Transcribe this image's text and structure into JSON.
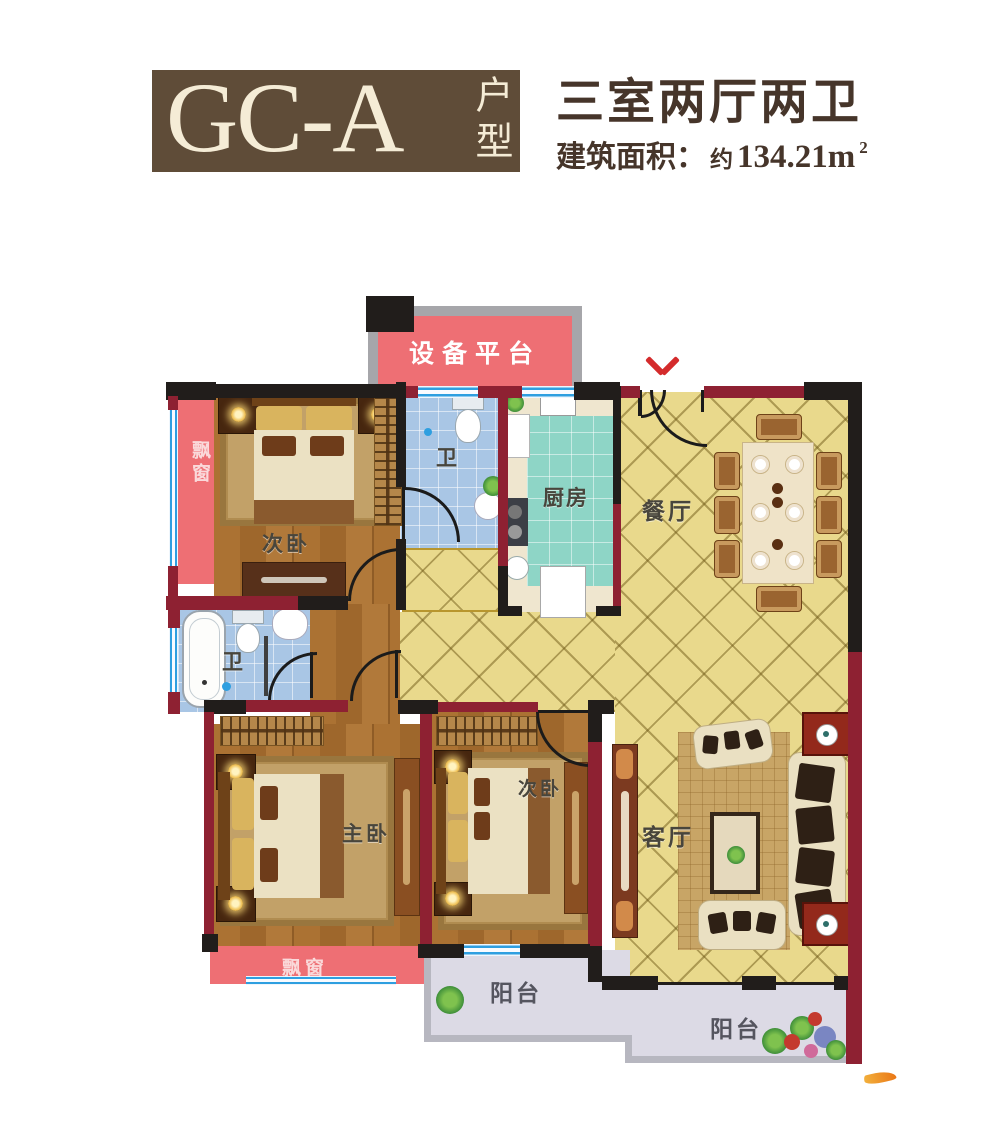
{
  "header": {
    "plan_code": "GC-A",
    "plan_type": "户型",
    "title": "三室两厅两卫",
    "area_label": "建筑面积：",
    "area_approx": "约",
    "area_value": "134.21m",
    "area_exponent": "2"
  },
  "rooms": {
    "equipment_platform": "设备平台",
    "bedroom_top": "次卧",
    "bathroom_top": "卫",
    "kitchen": "厨房",
    "dining_room": "餐厅",
    "bathroom_middle": "卫",
    "master_bedroom": "主卧",
    "bedroom_bottom": "次卧",
    "living_room": "客厅",
    "balcony_small": "阳台",
    "balcony_large": "阳台",
    "bay_window_left": "飘窗",
    "bay_window_bottom": "飘窗"
  },
  "colors": {
    "brand_brown": "#5f4c38",
    "title_brown": "#46352a",
    "wall_black": "#211d1b",
    "wall_red": "#8e2132",
    "window_blue": "#2e9fe0",
    "bay_pink": "#ee6f74",
    "tile_yellow": "#e9d98c",
    "kitchen_teal": "#8ed5c6",
    "bath_blue": "#a9c6e5",
    "balcony_gray": "#dcdae5",
    "entry_arrow_red": "#d42b2c",
    "watermark_orange": "#ea7716"
  }
}
